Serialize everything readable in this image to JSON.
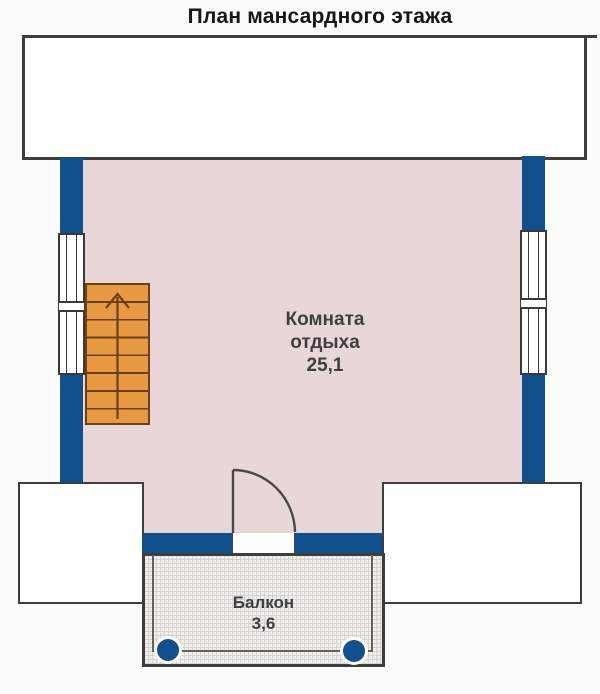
{
  "title": "План мансардного этажа",
  "room": {
    "name_line1": "Комната",
    "name_line2": "отдыха",
    "area": "25,1"
  },
  "balcony": {
    "name": "Балкон",
    "area": "3,6"
  },
  "icons": {
    "stairs_direction": "up-arrow-icon",
    "door": "door-swing-arc-icon"
  },
  "colors": {
    "wall_blue": "#11508d",
    "room_fill": "#e9d6d6",
    "stairs_fill": "#e79a41",
    "stairs_line": "#6b4012",
    "outline": "#3e3e3e",
    "balcony_floor": "#efeeea",
    "text": "#3f3f3f",
    "title_text": "#161616",
    "bg": "#fbfbfa"
  }
}
